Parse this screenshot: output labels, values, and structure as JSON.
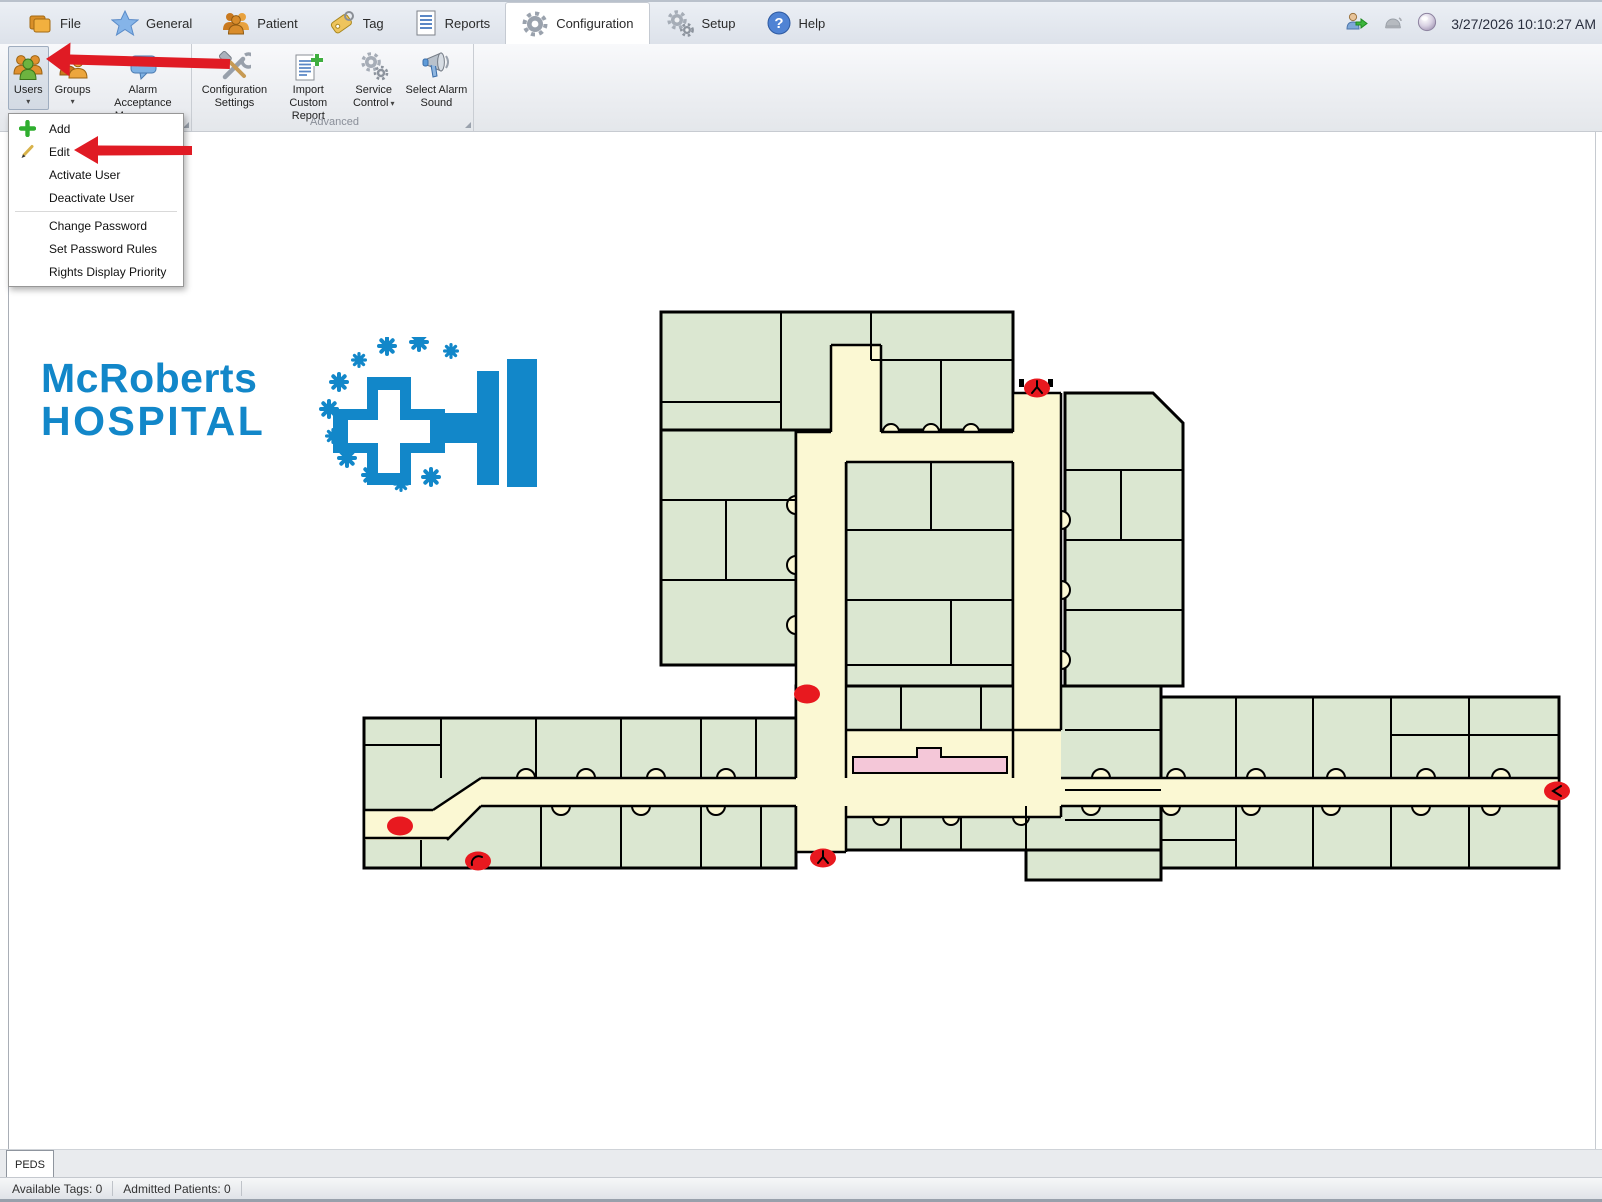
{
  "window": {
    "datetime": "3/27/2026 10:10:27 AM",
    "titlebar_icons": [
      "user-login-icon",
      "alarm-disabled-icon",
      "sphere-status-icon"
    ]
  },
  "ribbon_tabs": [
    {
      "label": "File",
      "icon": "folder-icon",
      "active": false
    },
    {
      "label": "General",
      "icon": "star-icon",
      "active": false
    },
    {
      "label": "Patient",
      "icon": "patients-icon",
      "active": false
    },
    {
      "label": "Tag",
      "icon": "tag-icon",
      "active": false
    },
    {
      "label": "Reports",
      "icon": "report-icon",
      "active": false
    },
    {
      "label": "Configuration",
      "icon": "gear-icon",
      "active": true
    },
    {
      "label": "Setup",
      "icon": "gears-icon",
      "active": false
    },
    {
      "label": "Help",
      "icon": "help-icon",
      "active": false
    }
  ],
  "toolbar": {
    "groups": [
      {
        "name": "",
        "buttons": [
          {
            "label": "Users",
            "icon": "users-icon",
            "has_dropdown": true,
            "pressed": true
          },
          {
            "label": "Groups",
            "icon": "groups-icon",
            "has_dropdown": true,
            "pressed": false
          },
          {
            "label": "Alarm Acceptance Messages",
            "icon": "alarm-messages-icon",
            "has_dropdown": true,
            "pressed": false
          }
        ]
      },
      {
        "name": "Advanced",
        "buttons": [
          {
            "label": "Configuration Settings",
            "icon": "config-settings-icon",
            "has_dropdown": false
          },
          {
            "label": "Import Custom Report",
            "icon": "import-report-icon",
            "has_dropdown": false
          },
          {
            "label": "Service Control",
            "icon": "service-gears-icon",
            "has_dropdown": true
          },
          {
            "label": "Select Alarm Sound",
            "icon": "alarm-sound-icon",
            "has_dropdown": false
          }
        ]
      }
    ]
  },
  "users_menu": {
    "items": [
      {
        "label": "Add",
        "icon": "add-icon"
      },
      {
        "label": "Edit",
        "icon": "edit-icon"
      },
      {
        "label": "Activate User",
        "icon": null
      },
      {
        "label": "Deactivate User",
        "icon": null,
        "divider_after": true
      },
      {
        "label": "Change Password",
        "icon": null
      },
      {
        "label": "Set Password Rules",
        "icon": null
      },
      {
        "label": "Rights Display Priority",
        "icon": null
      }
    ]
  },
  "annotations": {
    "arrow_color": "#e01b24",
    "arrows": [
      {
        "points_to": "users-button"
      },
      {
        "points_to": "edit-menu-item"
      }
    ]
  },
  "logo": {
    "line1": "McRoberts",
    "line2": "HOSPITAL",
    "color": "#1287c9"
  },
  "map": {
    "room_color": "#dbe7d1",
    "corridor_color": "#fbf8d3",
    "counter_color": "#f4c7d8",
    "wall_color": "#000000",
    "alert_color": "#e8191f",
    "alert_dots": [
      {
        "x": 1036,
        "y": 388,
        "mark": "y-mark"
      },
      {
        "x": 806,
        "y": 694,
        "mark": null
      },
      {
        "x": 399,
        "y": 826,
        "mark": null
      },
      {
        "x": 477,
        "y": 861,
        "mark": "arc-mark"
      },
      {
        "x": 822,
        "y": 858,
        "mark": "y-mark"
      },
      {
        "x": 1556,
        "y": 791,
        "mark": "angle-mark"
      }
    ]
  },
  "bottom_tabs": [
    {
      "label": "PEDS",
      "active": true
    }
  ],
  "status_bar": {
    "items": [
      "Available Tags: 0",
      "Admitted Patients: 0"
    ]
  }
}
